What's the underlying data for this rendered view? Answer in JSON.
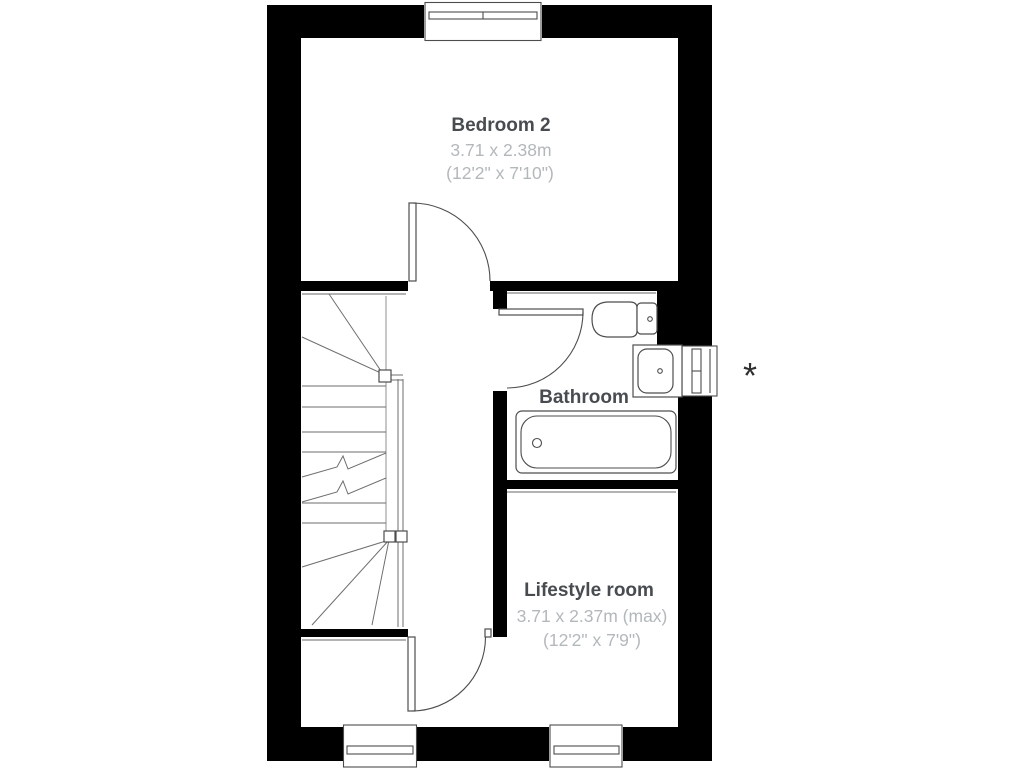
{
  "floor_plan": {
    "background": "#ffffff",
    "colors": {
      "wall": "#000000",
      "line": "#4d4d4d",
      "stairline": "#6e6e6e",
      "faceline": "#9a9a9a",
      "label": "#484c50",
      "dimension": "#b3b8bb",
      "annotation": "#2f2f2f"
    },
    "rooms": [
      {
        "name": "Bedroom 2",
        "size_metric": "3.71 x 2.38m",
        "size_imperial": "(12'2\" x 7'10\")"
      },
      {
        "name": "Bathroom"
      },
      {
        "name": "Lifestyle room",
        "size_metric": "3.71 x 2.37m (max)",
        "size_imperial": "(12'2\" x 7'9\")"
      }
    ],
    "annotation": {
      "symbol": "*"
    }
  }
}
